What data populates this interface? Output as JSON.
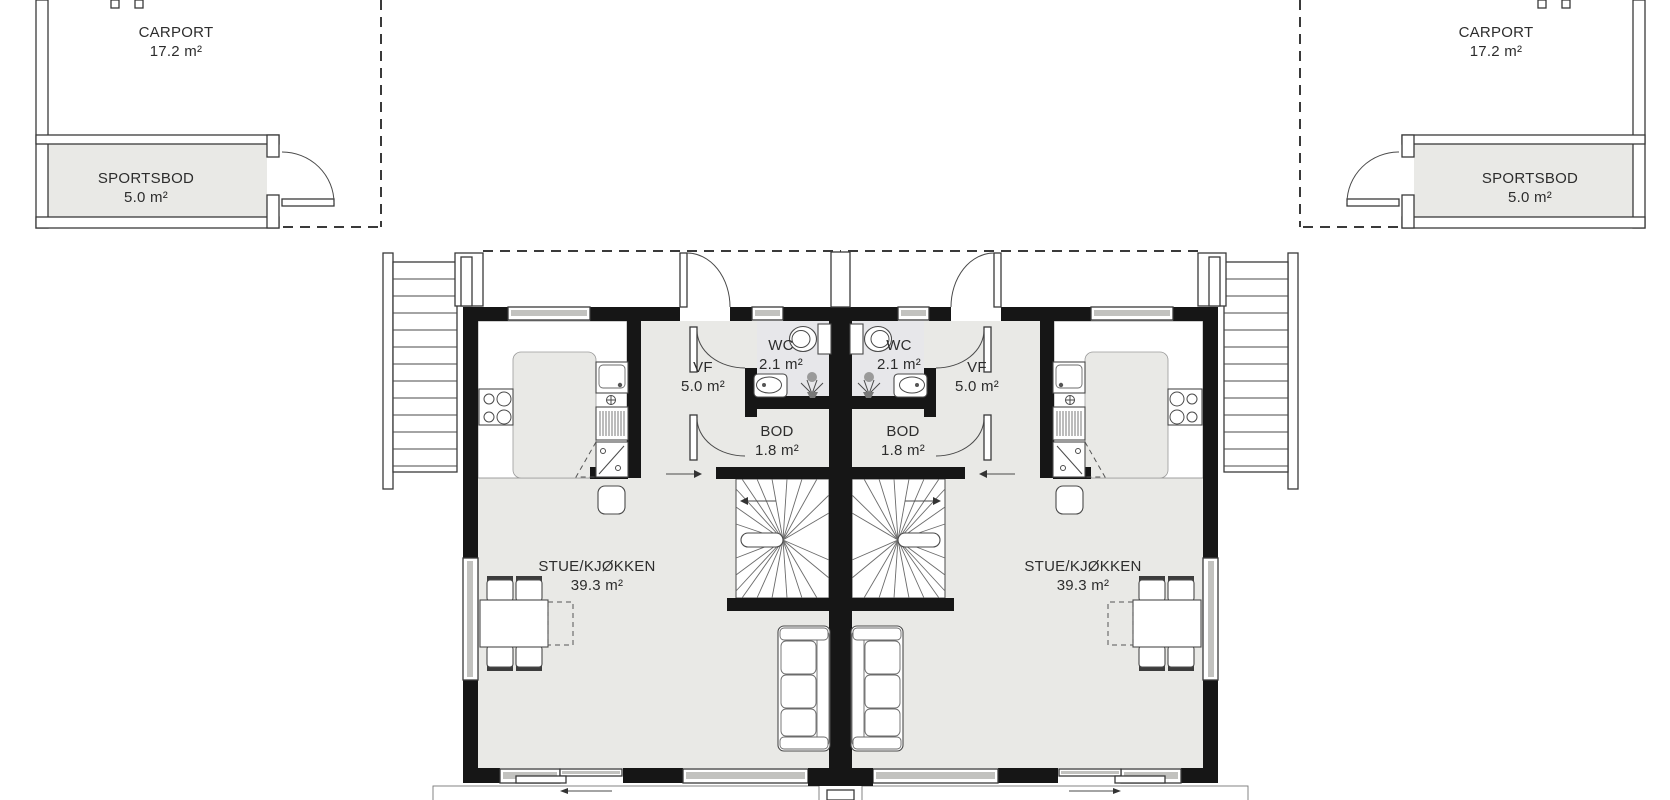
{
  "rooms": {
    "carport_left": {
      "label": "CARPORT",
      "area": "17.2 m²"
    },
    "sportsbod_left": {
      "label": "SPORTSBOD",
      "area": "5.0 m²"
    },
    "carport_right": {
      "label": "CARPORT",
      "area": "17.2 m²"
    },
    "sportsbod_right": {
      "label": "SPORTSBOD",
      "area": "5.0 m²"
    },
    "living_left": {
      "label": "STUE/KJØKKEN",
      "area": "39.3 m²"
    },
    "vf_left": {
      "label": "VF",
      "area": "5.0 m²"
    },
    "wc_left": {
      "label": "WC",
      "area": "2.1 m²"
    },
    "bod_left": {
      "label": "BOD",
      "area": "1.8 m²"
    },
    "living_right": {
      "label": "STUE/KJØKKEN",
      "area": "39.3 m²"
    },
    "vf_right": {
      "label": "VF",
      "area": "5.0 m²"
    },
    "wc_right": {
      "label": "WC",
      "area": "2.1 m²"
    },
    "bod_right": {
      "label": "BOD",
      "area": "1.8 m²"
    }
  },
  "colors": {
    "wall": "#161616",
    "floor": "#e9e9e6",
    "wc_floor": "#e7e7ea",
    "window_glass": "#c2c2bf",
    "line": "#4a4a4a"
  }
}
